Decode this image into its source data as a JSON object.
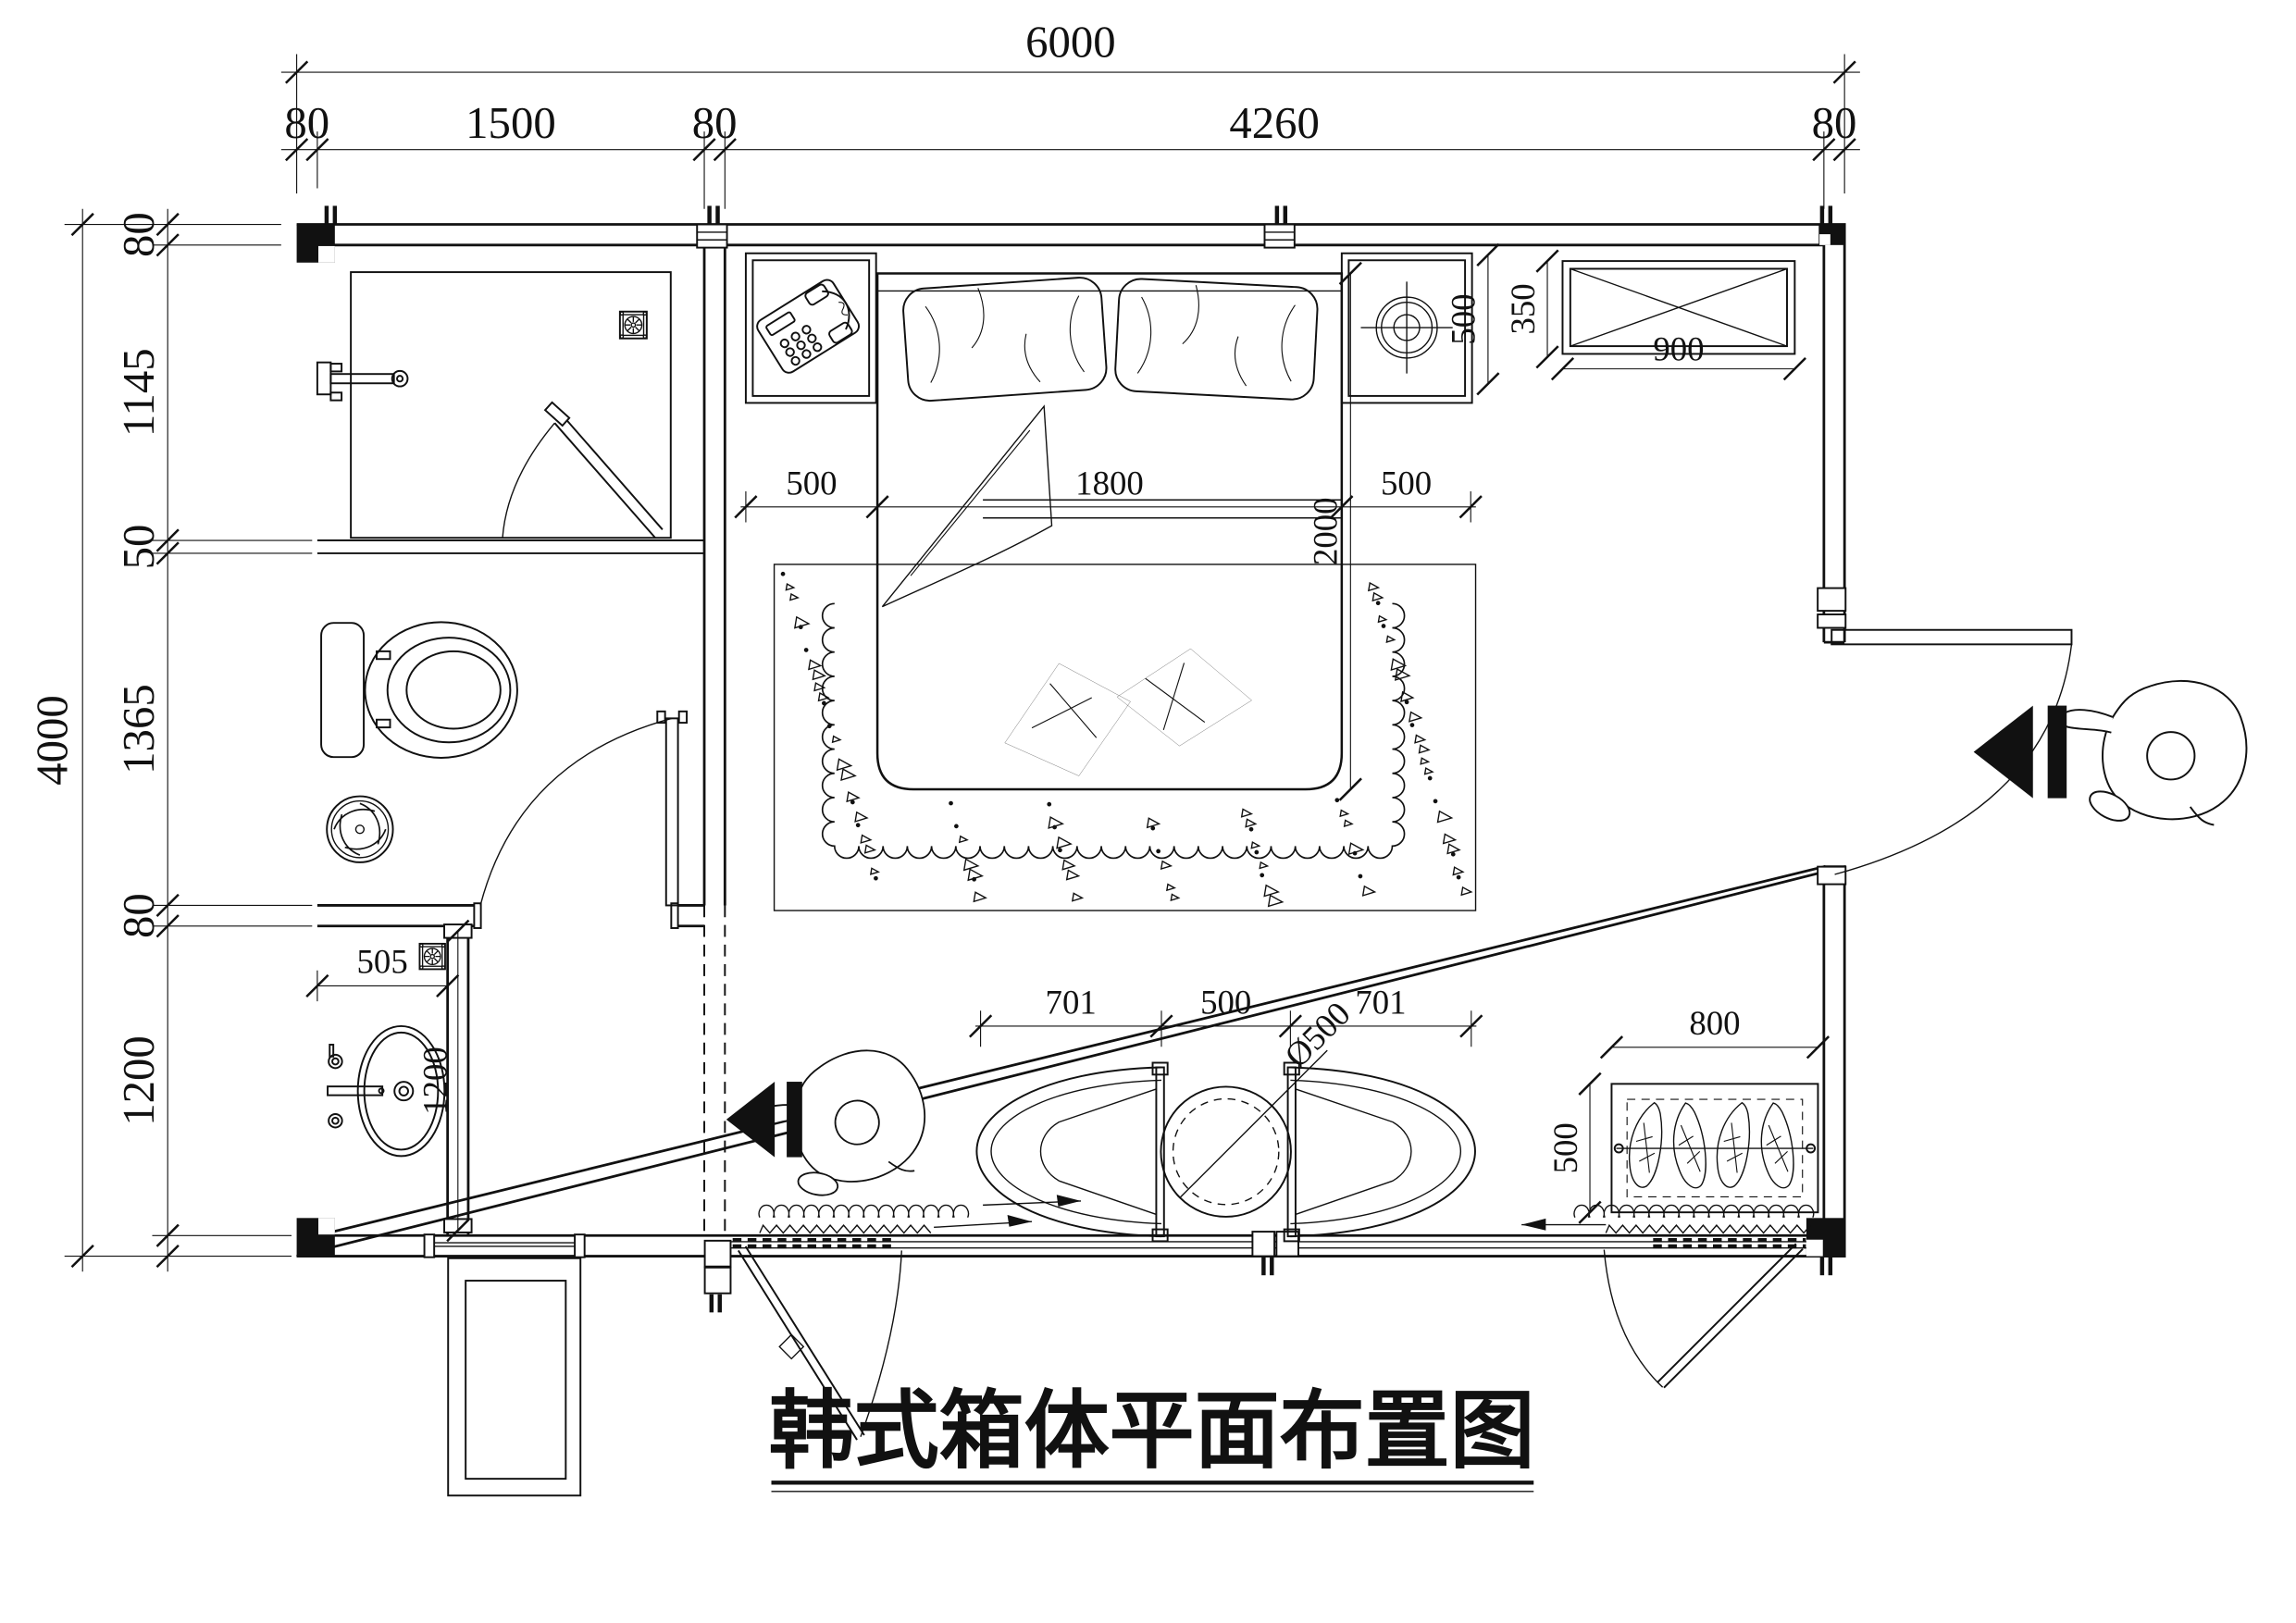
{
  "title": {
    "text": "韩式箱体平面布置图"
  },
  "dims": {
    "overall_w": "6000",
    "overall_h": "4000",
    "top": [
      "80",
      "1500",
      "80",
      "4260",
      "80"
    ],
    "left": [
      "80",
      "1145",
      "50",
      "1365",
      "80",
      "1200"
    ],
    "bed_row": [
      "500",
      "1800",
      "500"
    ],
    "bed_len": "2000",
    "nightstand_depth": "500",
    "cabinet_w": "900",
    "cabinet_d": "350",
    "vanity_w": "505",
    "vanity_d": "1200",
    "chair_row": [
      "701",
      "500",
      "701"
    ],
    "table_dia": "Ø500",
    "planter_w": "800",
    "planter_d": "500"
  }
}
